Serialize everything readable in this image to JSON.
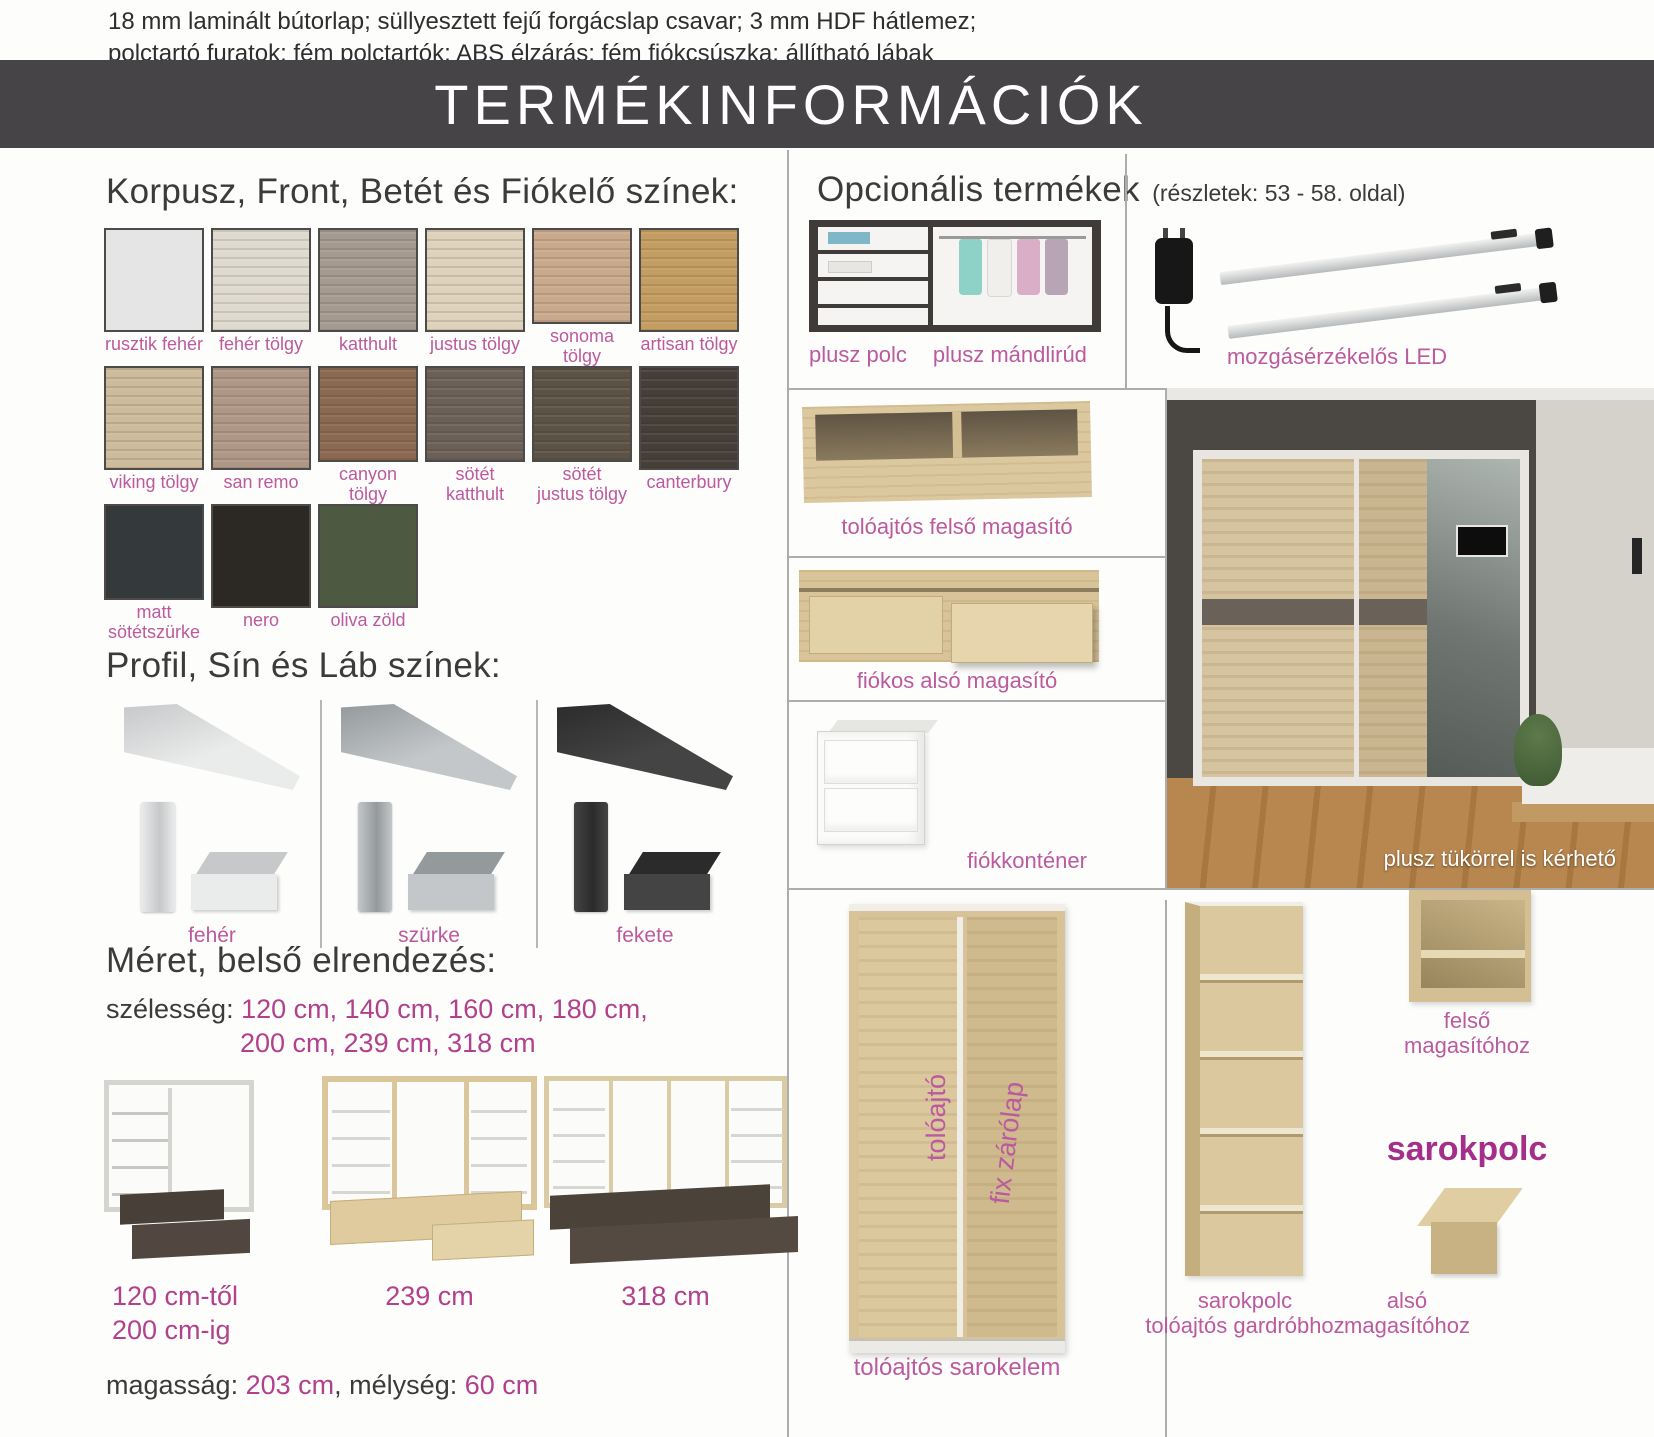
{
  "colors": {
    "label_pink": "#bb5a9e",
    "value_pink": "#b2418d",
    "accent_magenta": "#a42f8a",
    "text_dark": "#3b3b3b",
    "title_bar_bg": "#474448",
    "divider_gray": "#adadad",
    "oak_light": "#dcc89f",
    "white_text": "#ffffff"
  },
  "header": {
    "note_line1": "18 mm laminált bútorlap; süllyesztett fejű forgácslap csavar; 3 mm HDF hátlemez;",
    "note_line2": "polctartó furatok; fém polctartók; ABS élzárás; fém fiókcsúszka; állítható lábak",
    "title": "TERMÉKINFORMÁCIÓK"
  },
  "colors_section": {
    "heading": "Korpusz, Front, Betét és Fiókelő színek:",
    "swatches": [
      {
        "label": "rusztik fehér",
        "color": "#e4e5e4",
        "wood": false
      },
      {
        "label": "fehér tölgy",
        "color": "#dedacf",
        "wood": true
      },
      {
        "label": "katthult",
        "color": "#a49a90",
        "wood": true
      },
      {
        "label": "justus tölgy",
        "color": "#ded2bc",
        "wood": true
      },
      {
        "label": "sonoma tölgy",
        "color": "#c9a98b",
        "wood": true
      },
      {
        "label": "artisan tölgy",
        "color": "#c49d62",
        "wood": true
      },
      {
        "label": "viking tölgy",
        "color": "#cdbb9c",
        "wood": true
      },
      {
        "label": "san remo",
        "color": "#af9786",
        "wood": true
      },
      {
        "label": "canyon tölgy",
        "color": "#8b6850",
        "wood": true
      },
      {
        "label": "sötét katthult",
        "color": "#6b6057",
        "wood": true
      },
      {
        "label": "sötét\njustus tölgy",
        "color": "#5b5345",
        "wood": true
      },
      {
        "label": "canterbury",
        "color": "#453f38",
        "wood": true
      },
      {
        "label": "matt\nsötétszürke",
        "color": "#343a3c",
        "wood": false
      },
      {
        "label": "nero",
        "color": "#2c2823",
        "wood": false
      },
      {
        "label": "oliva zöld",
        "color": "#4d5a41",
        "wood": false
      }
    ]
  },
  "profile_section": {
    "heading": "Profil, Sín és Láb színek:",
    "items": [
      {
        "label": "fehér",
        "color": "#eaebeb",
        "edge": "#c6c8c9"
      },
      {
        "label": "szürke",
        "color": "#c3c7c9",
        "edge": "#94999c"
      },
      {
        "label": "fekete",
        "color": "#444444",
        "edge": "#2b2b2b"
      }
    ]
  },
  "size_section": {
    "heading": "Méret, belső elrendezés:",
    "width_label": "szélesség:",
    "width_line1": "120 cm, 140 cm, 160 cm, 180 cm,",
    "width_line2": "200 cm, 239 cm, 318 cm",
    "captions": [
      {
        "line1": "120 cm-től",
        "line2": "200 cm-ig"
      },
      {
        "line1": "239 cm",
        "line2": ""
      },
      {
        "line1": "318 cm",
        "line2": ""
      }
    ],
    "height_label": "magasság:",
    "height_value": "203 cm",
    "separator": ",",
    "depth_label": "mélység:",
    "depth_value": "60 cm"
  },
  "optional_section": {
    "heading": "Opcionális termékek",
    "note": "(részletek: 53 - 58. oldal)",
    "labels": {
      "plusz_polc": "plusz polc",
      "plusz_mandlirud": "plusz mándlirúd",
      "mozgaserzekelos_led": "mozgásérzékelős LED",
      "toloajtos_felso_magasito": "tolóajtós felső magasító",
      "fiokos_also_magasito": "fiókos alsó magasító",
      "fiokkontener": "fiókkonténer",
      "plusz_tukorrel": "plusz tükörrel is kérhető",
      "toloajto": "tolóajtó",
      "fix_zarolap": "fix zárólap",
      "toloajtos_sarokelem": "tolóajtós sarokelem",
      "felso_magasitohoz": "felső\nmagasítóhoz",
      "sarokpolc": "sarokpolc",
      "sarokpolc_gardrobhoz": "sarokpolc\ntolóajtós gardróbhoz",
      "also_magasitohoz": "alsó\nmagasítóhoz"
    }
  }
}
